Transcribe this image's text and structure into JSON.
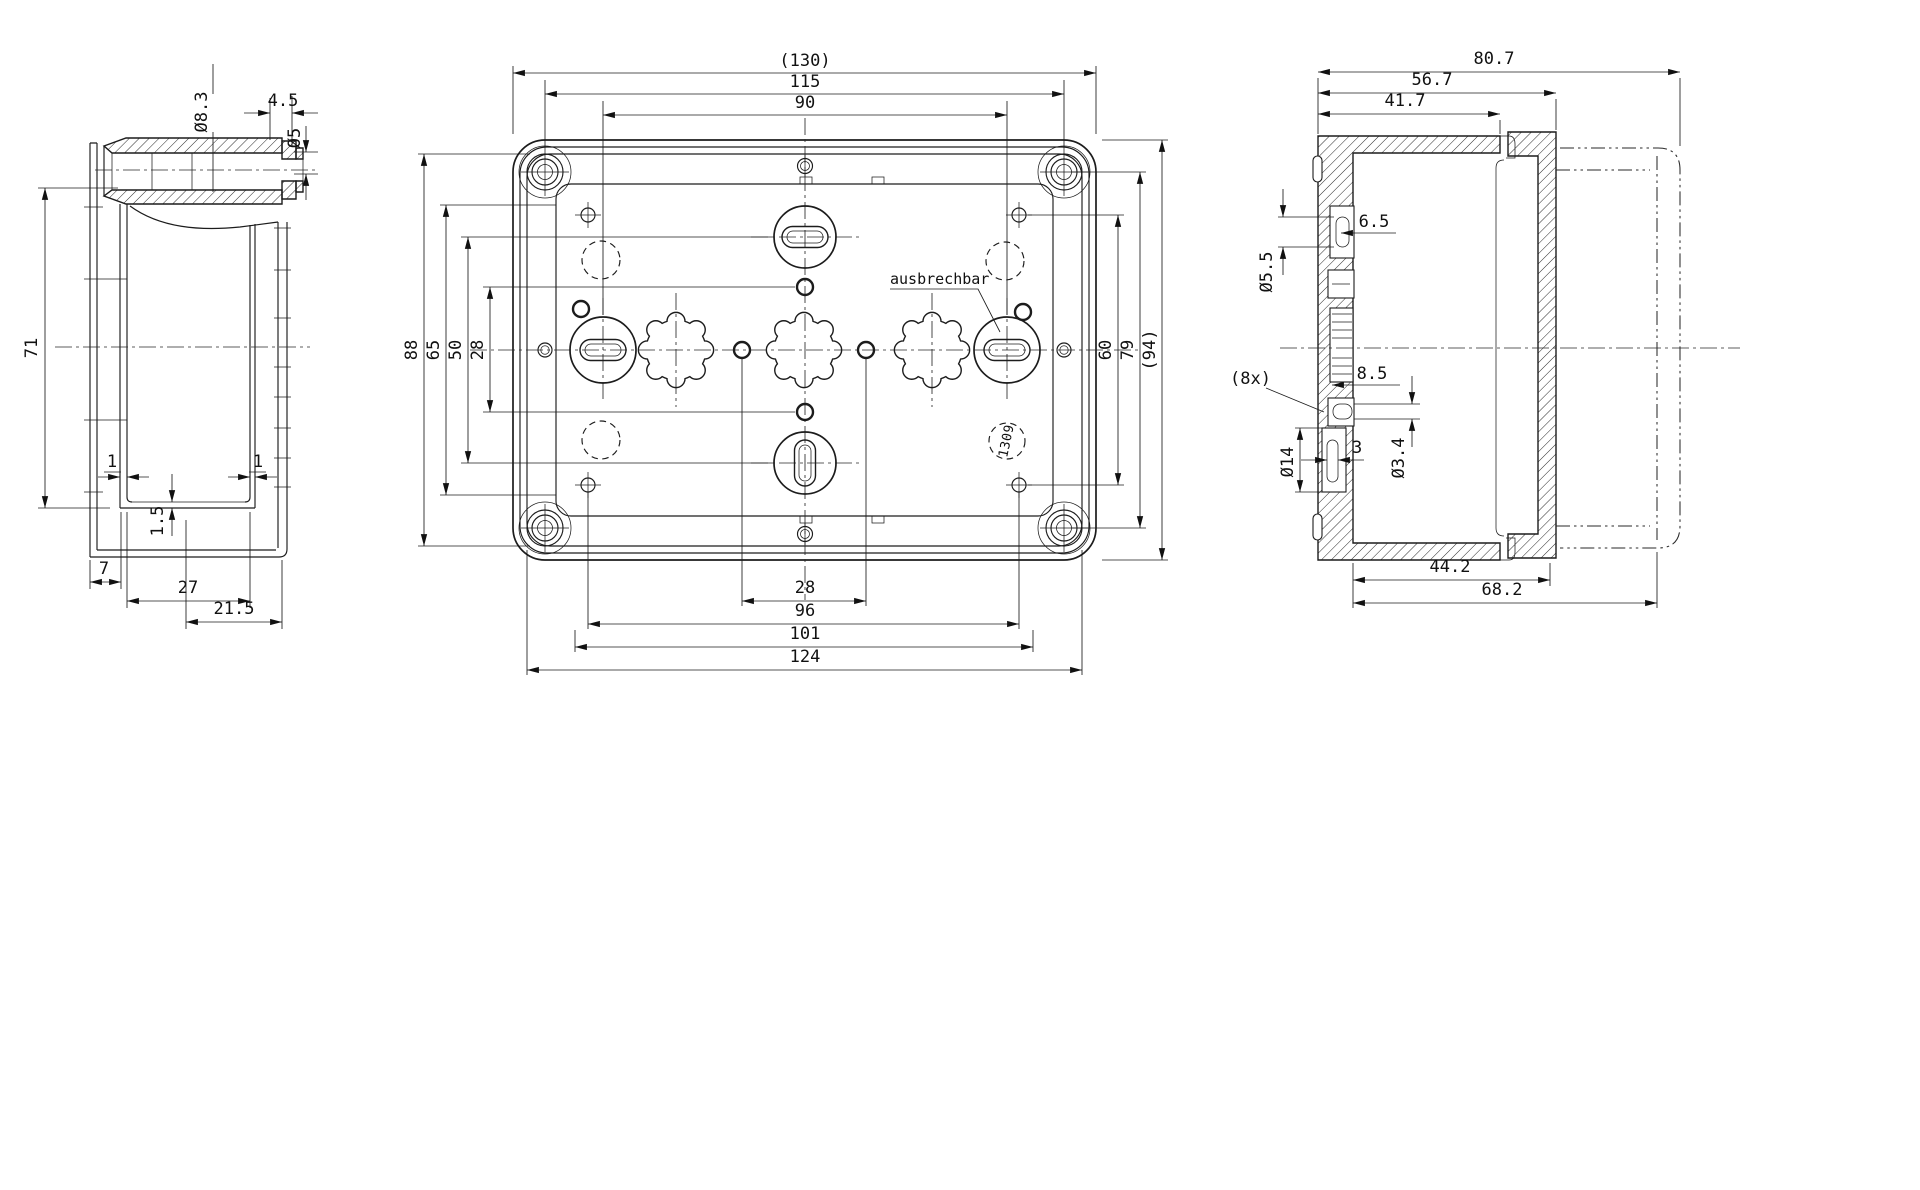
{
  "drawing": {
    "left_view": {
      "dia_bore": "Ø8.3",
      "tip_len": "4.5",
      "dia_tip": "Ø5",
      "height": "71",
      "wall_l": "1",
      "wall_r": "1",
      "floor_t": "1.5",
      "off_7": "7",
      "inner_w": "27",
      "off_21_5": "21.5"
    },
    "plan_view": {
      "w130": "(130)",
      "w115": "115",
      "w90": "90",
      "h88": "88",
      "h65": "65",
      "h50": "50",
      "h28": "28",
      "h60": "60",
      "h79": "79",
      "h94": "(94)",
      "b28": "28",
      "b96": "96",
      "b101": "101",
      "b124": "124",
      "note_knockout": "ausbrechbar",
      "mold_no": "1309"
    },
    "right_view": {
      "w80_7": "80.7",
      "w56_7": "56.7",
      "w41_7": "41.7",
      "n6_5": "6.5",
      "dia5_5": "Ø5.5",
      "count8": "(8x)",
      "n8_5": "8.5",
      "dia14": "Ø14",
      "n3": "3",
      "dia3_4": "Ø3.4",
      "b44_2": "44.2",
      "b68_2": "68.2"
    }
  }
}
